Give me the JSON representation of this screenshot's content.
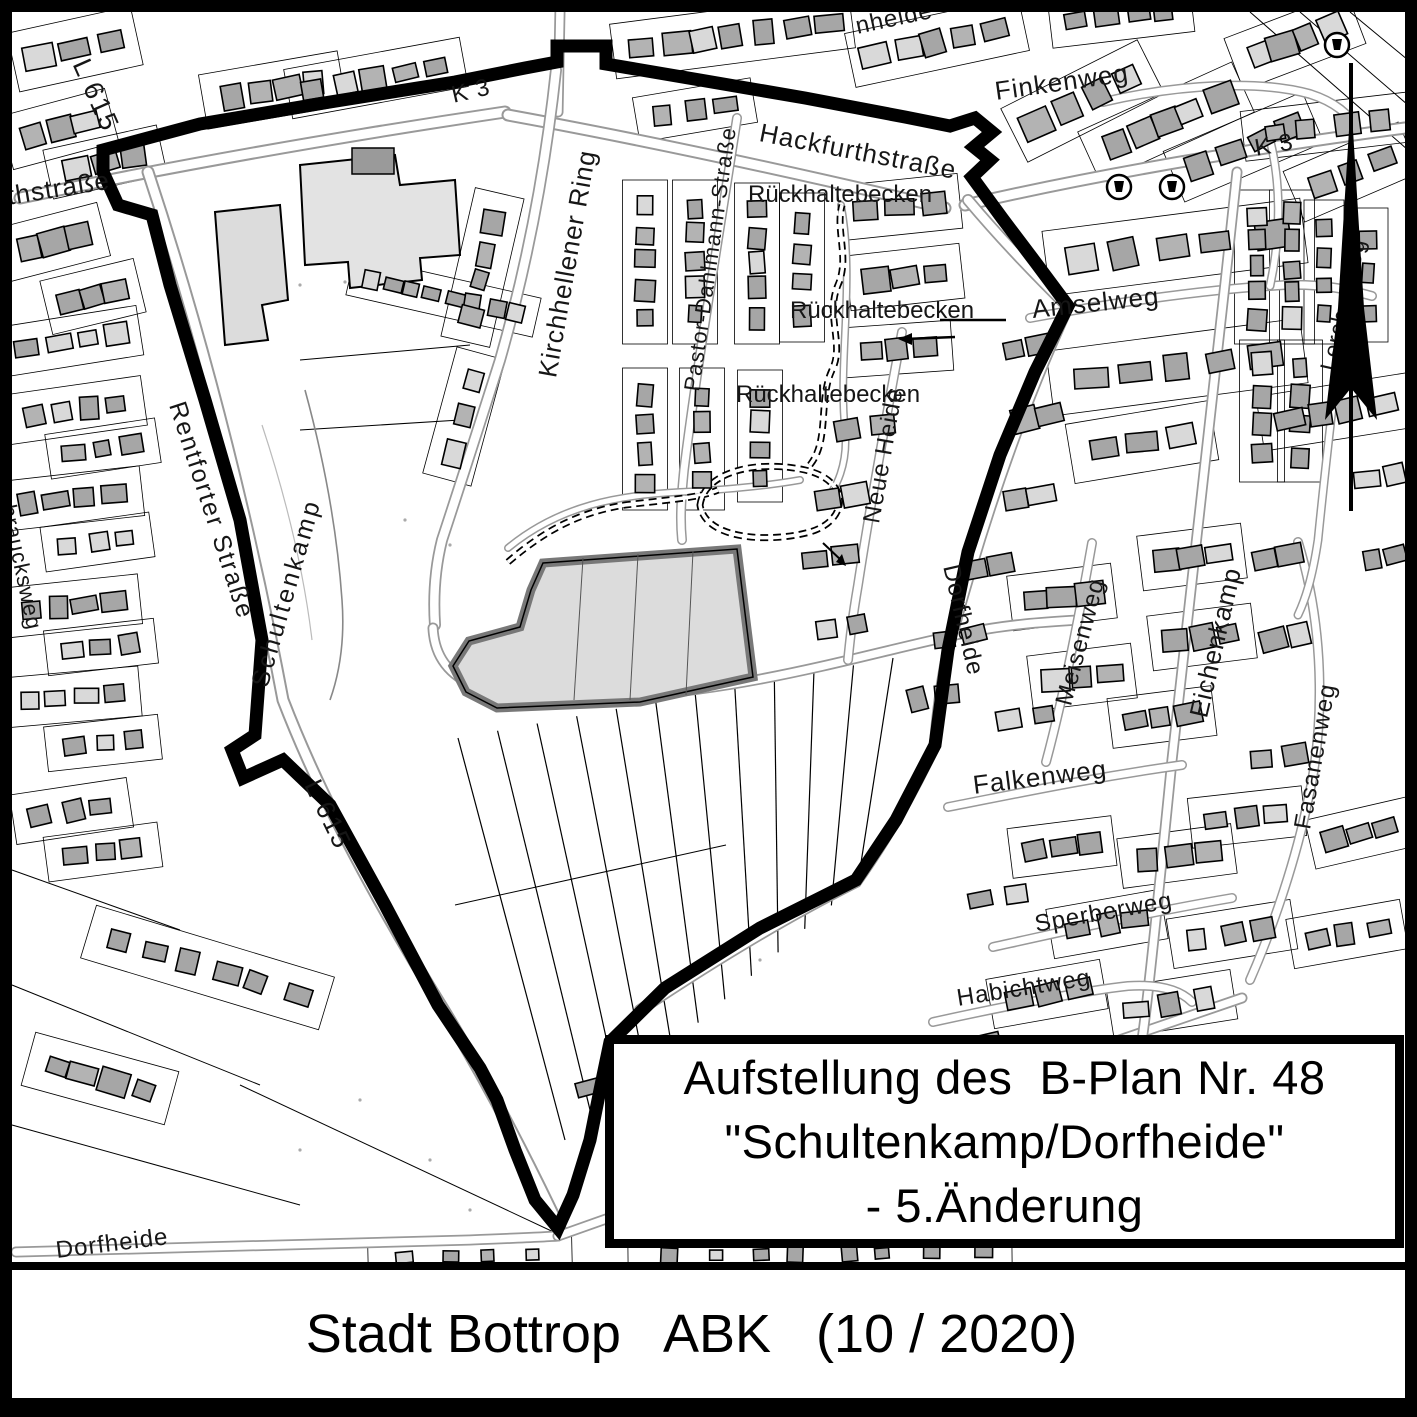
{
  "title_box": {
    "line1": "Aufstellung des  B-Plan Nr. 48",
    "line2": "\"Schultenkamp/Dorfheide\"",
    "line3": "- 5.Änderung"
  },
  "footer": {
    "text": "Stadt Bottrop   ABK   (10 / 2020)"
  },
  "map": {
    "colors": {
      "building": "#a6a6a6",
      "building_light": "#d9d9d9",
      "road_casing": "#999999",
      "boundary": "#000000",
      "change_area_fill": "#dcdcdc",
      "change_area_border": "#787878"
    },
    "icons": [
      {
        "name": "north-arrow"
      },
      {
        "name": "well-icon",
        "count": 3
      }
    ],
    "labels": [
      {
        "id": "l615-top",
        "text": "L 615",
        "x": 80,
        "y": 62,
        "rot": 66,
        "size": 27,
        "ls": 2
      },
      {
        "id": "hackfurthstrasse-west",
        "text": "Hackfurthstraße",
        "x": -88,
        "y": 212,
        "rot": -9,
        "size": 26,
        "ls": 1
      },
      {
        "id": "k3-west",
        "text": "K 3",
        "x": 452,
        "y": 97,
        "rot": -13,
        "size": 24,
        "ls": 1
      },
      {
        "id": "hackfurthstrasse",
        "text": "Hackfurthstraße",
        "x": 760,
        "y": 133,
        "rot": 11,
        "size": 26,
        "ls": 1
      },
      {
        "id": "finkenweg",
        "text": "Finkenweg",
        "x": 995,
        "y": 92,
        "rot": -8,
        "size": 26,
        "ls": 1
      },
      {
        "id": "k3-east",
        "text": "K 3",
        "x": 1255,
        "y": 150,
        "rot": -10,
        "size": 24,
        "ls": 1
      },
      {
        "id": "rueckhaltebecken-1",
        "text": "Rückhaltebecken",
        "x": 748,
        "y": 196,
        "rot": 0,
        "size": 24,
        "ls": 0
      },
      {
        "id": "rueckhaltebecken-2",
        "text": "Rückhaltebecken",
        "x": 790,
        "y": 312,
        "rot": 0,
        "size": 24,
        "ls": 0
      },
      {
        "id": "rueckhaltebecken-3",
        "text": "Rückhaltebecken",
        "x": 736,
        "y": 396,
        "rot": 0,
        "size": 24,
        "ls": 0
      },
      {
        "id": "kirchhellener-ring",
        "text": "Kirchhellener Ring",
        "x": 547,
        "y": 378,
        "rot": -80,
        "size": 26,
        "ls": 1
      },
      {
        "id": "pastor-dahlmann-strasse",
        "text": "Pastor-Dahlmann-Straße",
        "x": 692,
        "y": 392,
        "rot": -82,
        "size": 22,
        "ls": 1
      },
      {
        "id": "schultenkamp",
        "text": "Schultenkamp",
        "x": 260,
        "y": 688,
        "rot": -74,
        "size": 25,
        "ls": 3
      },
      {
        "id": "rentforter-strasse",
        "text": "Rentforter Straße",
        "x": 176,
        "y": 404,
        "rot": 72,
        "size": 25,
        "ls": 2
      },
      {
        "id": "neue-heide",
        "text": "Neue Heide",
        "x": 872,
        "y": 524,
        "rot": -80,
        "size": 24,
        "ls": 1
      },
      {
        "id": "amselweg",
        "text": "Amselweg",
        "x": 1032,
        "y": 310,
        "rot": -6,
        "size": 26,
        "ls": 1
      },
      {
        "id": "dorfheide-street",
        "text": "Dorfheide",
        "x": 950,
        "y": 566,
        "rot": 77,
        "size": 24,
        "ls": 1
      },
      {
        "id": "meisenweg",
        "text": "Meisenweg",
        "x": 1064,
        "y": 706,
        "rot": -75,
        "size": 24,
        "ls": 1
      },
      {
        "id": "eichenkamp",
        "text": "Eichenkamp",
        "x": 1198,
        "y": 718,
        "rot": -77,
        "size": 26,
        "ls": 1
      },
      {
        "id": "fasanenweg",
        "text": "Fasanenweg",
        "x": 1303,
        "y": 830,
        "rot": -80,
        "size": 24,
        "ls": 1
      },
      {
        "id": "falkenweg",
        "text": "Falkenweg",
        "x": 973,
        "y": 786,
        "rot": -7,
        "size": 26,
        "ls": 1
      },
      {
        "id": "sperberweg",
        "text": "Sperberweg",
        "x": 1035,
        "y": 926,
        "rot": -10,
        "size": 24,
        "ls": 1
      },
      {
        "id": "habichtweg",
        "text": "Habichtweg",
        "x": 957,
        "y": 1000,
        "rot": -9,
        "size": 24,
        "ls": 1
      },
      {
        "id": "l615-south",
        "text": "L 615",
        "x": 312,
        "y": 782,
        "rot": 64,
        "size": 26,
        "ls": 2
      },
      {
        "id": "dorfheide-south",
        "text": "Dorfheide",
        "x": 56,
        "y": 1252,
        "rot": -7,
        "size": 24,
        "ls": 1
      },
      {
        "id": "heide-fragment",
        "text": "nheide",
        "x": 856,
        "y": 28,
        "rot": -12,
        "size": 24,
        "ls": 1
      },
      {
        "id": "lerchenweg",
        "text": "Lerchenweg",
        "x": 1328,
        "y": 372,
        "rot": -77,
        "size": 23,
        "ls": 1
      },
      {
        "id": "braucksweg",
        "text": "braucksweg",
        "x": 8,
        "y": 506,
        "rot": 78,
        "size": 22,
        "ls": 1
      }
    ]
  }
}
